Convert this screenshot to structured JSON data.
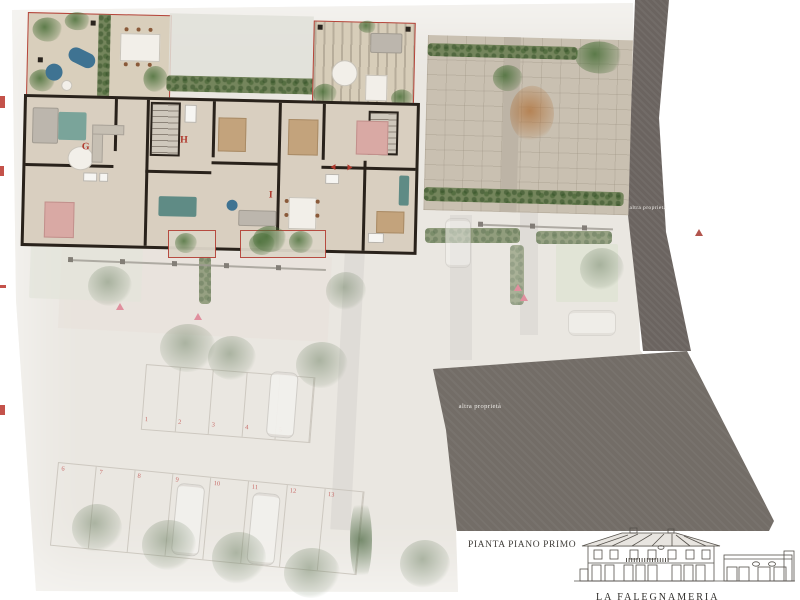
{
  "document": {
    "plan_title": "PIANTA PIANO PRIMO",
    "project_title": "LA FALEGNAMERIA"
  },
  "plan": {
    "neighbor_property_label": "altra proprietà",
    "units": [
      {
        "letter": "G"
      },
      {
        "letter": "H"
      },
      {
        "letter": "I"
      }
    ],
    "parking": {
      "row_upper": [
        "1",
        "2",
        "3",
        "4",
        "5"
      ],
      "row_lower": [
        "6",
        "7",
        "8",
        "9",
        "10",
        "11",
        "12",
        "13"
      ]
    },
    "colors": {
      "page_bg": "#ffffff",
      "ground": "#eae7e1",
      "building_floor": "#d9cfc0",
      "walls": "#29221b",
      "red_outline": "#b5443a",
      "unit_letter_red": "#b03a2e",
      "parking_number_red": "#c0504d",
      "hedge_green": "#74855c",
      "stone_paving": "#c9c0b1",
      "neighbor_dark_band": "#6b6460",
      "neighbor_dark_area": "#736d67",
      "bed_pink": "#d9a9a4",
      "bed_tan": "#c3a37c",
      "sofa_teal": "#5f8b85",
      "lounge_blue": "#3f7392",
      "marker_pink": "#e08f9e"
    }
  }
}
